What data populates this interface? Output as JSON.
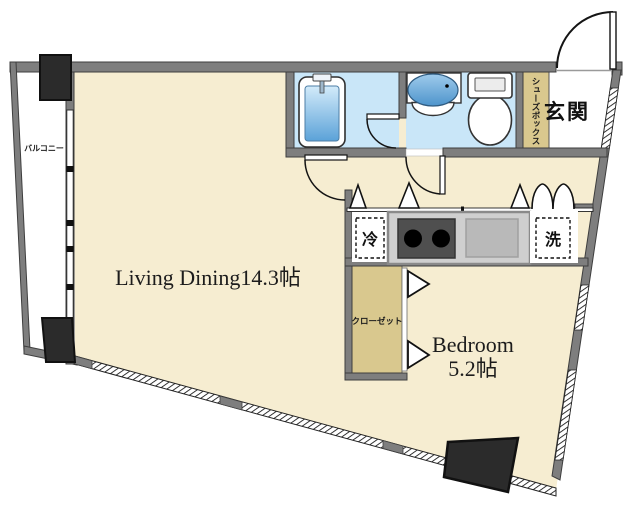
{
  "plan": {
    "type": "apartment-floor-plan",
    "rooms": {
      "living": {
        "label": "Living Dining14.3帖"
      },
      "bedroom": {
        "name": "Bedroom",
        "size": "5.2帖"
      },
      "entrance": {
        "label": "玄関"
      },
      "balcony": {
        "label": "バルコニー"
      },
      "shoebox": {
        "label": "シューズボックス"
      },
      "closet": {
        "label": "クローゼット"
      },
      "fridge": {
        "label": "冷"
      },
      "washer": {
        "label": "洗"
      }
    },
    "fixtures": [
      "bathtub",
      "wash-basin",
      "toilet",
      "stove-burners",
      "kitchen-sink",
      "entrance-door",
      "bathroom-door",
      "washroom-door",
      "hall-door",
      "folding-doors",
      "closet-folding-doors",
      "windows",
      "pillars"
    ],
    "colors": {
      "floor_cream": "#f6edd1",
      "wet_room_blue": "#c9e6f8",
      "tan_storage": "#d9c88e",
      "wall_gray": "#7e7e7e",
      "wall_edge": "#3e3e3e",
      "pillar_black": "#2b2b2b",
      "counter_gray": "#cfcfcf",
      "stove_dark": "#4f4f4f",
      "tub_blue_top": "#d3ebfa",
      "tub_blue_bottom": "#5ba2d8"
    }
  }
}
